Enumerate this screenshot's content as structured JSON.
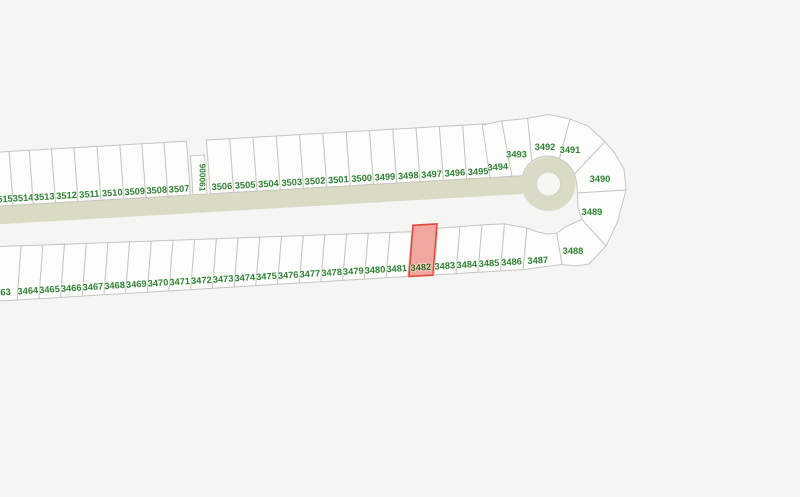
{
  "map": {
    "title": "subdivision-parcel-map",
    "highlighted_lot": "3482",
    "colors": {
      "background": "#f5f5f3",
      "parcel_fill": "#fdfdfc",
      "parcel_stroke": "#c6c5c1",
      "road": "#dadbc5",
      "lot_label": "#2f8132",
      "highlight_fill": "#f3a5a0",
      "highlight_stroke": "#e2493c",
      "highlight_label": "#33611a"
    },
    "lots": {
      "top_row": [
        "3515",
        "3514",
        "3513",
        "3512",
        "3511",
        "3510",
        "3509",
        "3508",
        "3507"
      ],
      "flag_parcel": "900061",
      "top_row_2": [
        "3506",
        "3505",
        "3504",
        "3503",
        "3502",
        "3501",
        "3500",
        "3499",
        "3498",
        "3497",
        "3496",
        "3495"
      ],
      "culdesac": [
        "3494",
        "3493",
        "3492",
        "3491",
        "3490",
        "3489",
        "3488"
      ],
      "bottom_row": [
        "3463",
        "3464",
        "3465",
        "3466",
        "3467",
        "3468",
        "3469",
        "3470",
        "3471",
        "3472",
        "3473",
        "3474",
        "3475",
        "3476",
        "3477",
        "3478",
        "3479",
        "3480",
        "3481"
      ],
      "bottom_row_2": [
        "3482",
        "3483",
        "3484",
        "3485",
        "3486",
        "3487"
      ]
    }
  }
}
